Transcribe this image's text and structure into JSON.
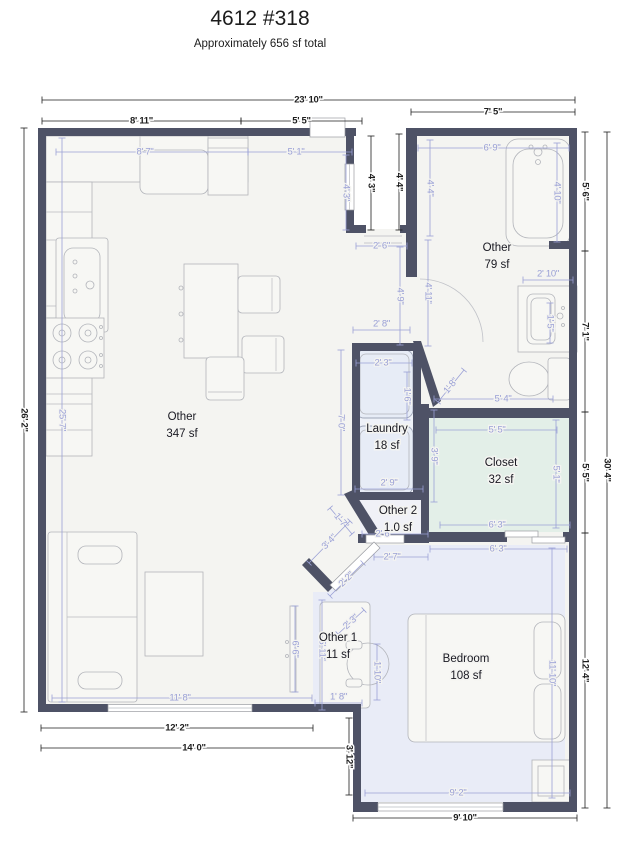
{
  "title": "4612 #318",
  "subtitle": "Approximately 656 sf total",
  "colors": {
    "wall": "#4e5266",
    "floor": "#f4f4f1",
    "bedroom_tint": "#e9ecf7",
    "closet_tint": "#e3efe8",
    "appliance_tint": "#e7ecf6",
    "dim_ext": "#1e1e1e",
    "dim_int": "#9aa0d6",
    "label": "#191922"
  },
  "rooms": [
    {
      "id": "other-main",
      "name": "Other",
      "area": "347 sf",
      "x": 182,
      "y": 420
    },
    {
      "id": "other-bath",
      "name": "Other",
      "area": "79 sf",
      "x": 497,
      "y": 251
    },
    {
      "id": "laundry",
      "name": "Laundry",
      "area": "18 sf",
      "x": 387,
      "y": 432
    },
    {
      "id": "closet",
      "name": "Closet",
      "area": "32 sf",
      "x": 501,
      "y": 466
    },
    {
      "id": "other-2",
      "name": "Other 2",
      "area": "1.0 sf",
      "x": 398,
      "y": 514
    },
    {
      "id": "other-1",
      "name": "Other 1",
      "area": "11 sf",
      "x": 338,
      "y": 641
    },
    {
      "id": "bedroom",
      "name": "Bedroom",
      "area": "108 sf",
      "x": 466,
      "y": 662
    }
  ],
  "ext_dims": [
    {
      "t": "23' 10\"",
      "x1": 42,
      "y1": 100,
      "x2": 575,
      "y2": 100
    },
    {
      "t": "8' 11\"",
      "x1": 42,
      "y1": 121,
      "x2": 241,
      "y2": 121
    },
    {
      "t": "5' 5\"",
      "x1": 241,
      "y1": 121,
      "x2": 362,
      "y2": 121
    },
    {
      "t": "7' 5\"",
      "x1": 411,
      "y1": 112,
      "x2": 575,
      "y2": 112
    },
    {
      "t": "4' 3\"",
      "x1": 371,
      "y1": 136,
      "x2": 371,
      "y2": 230
    },
    {
      "t": "4' 4\"",
      "x1": 399,
      "y1": 134,
      "x2": 399,
      "y2": 230
    },
    {
      "t": "5' 6\"",
      "x1": 585,
      "y1": 132,
      "x2": 585,
      "y2": 251
    },
    {
      "t": "7' 1\"",
      "x1": 585,
      "y1": 251,
      "x2": 585,
      "y2": 412
    },
    {
      "t": "5' 5\"",
      "x1": 585,
      "y1": 412,
      "x2": 585,
      "y2": 533
    },
    {
      "t": "12' 4\"",
      "x1": 585,
      "y1": 533,
      "x2": 585,
      "y2": 808
    },
    {
      "t": "30' 4\"",
      "x1": 607,
      "y1": 132,
      "x2": 607,
      "y2": 808
    },
    {
      "t": "26' 2\"",
      "x1": 24,
      "y1": 128,
      "x2": 24,
      "y2": 712
    },
    {
      "t": "12' 2\"",
      "x1": 41,
      "y1": 728,
      "x2": 313,
      "y2": 728
    },
    {
      "t": "14' 0\"",
      "x1": 41,
      "y1": 748,
      "x2": 347,
      "y2": 748
    },
    {
      "t": "3' 12\"",
      "x1": 349,
      "y1": 718,
      "x2": 349,
      "y2": 795
    },
    {
      "t": "9' 10\"",
      "x1": 353,
      "y1": 818,
      "x2": 577,
      "y2": 818
    }
  ],
  "int_dims": [
    {
      "t": "8' 7\"",
      "x1": 56,
      "y1": 152,
      "x2": 248,
      "y2": 152,
      "tx": 145
    },
    {
      "t": "5' 1\"",
      "x1": 248,
      "y1": 152,
      "x2": 352,
      "y2": 152,
      "tx": 296
    },
    {
      "t": "4' 3\"",
      "x1": 346,
      "y1": 155,
      "x2": 346,
      "y2": 230
    },
    {
      "t": "4' 4\"",
      "x1": 430,
      "y1": 140,
      "x2": 430,
      "y2": 236
    },
    {
      "t": "6' 9\"",
      "x1": 418,
      "y1": 148,
      "x2": 569,
      "y2": 148,
      "tx": 492
    },
    {
      "t": "4' 10\"",
      "x1": 557,
      "y1": 143,
      "x2": 557,
      "y2": 242
    },
    {
      "t": "2' 6\"",
      "x1": 356,
      "y1": 246,
      "x2": 407,
      "y2": 246
    },
    {
      "t": "4' 9\"",
      "x1": 400,
      "y1": 247,
      "x2": 400,
      "y2": 345
    },
    {
      "t": "4' 11\"",
      "x1": 428,
      "y1": 240,
      "x2": 428,
      "y2": 346
    },
    {
      "t": "2' 8\"",
      "x1": 353,
      "y1": 330,
      "x2": 410,
      "y2": 330,
      "ty": 324
    },
    {
      "t": "2' 10\"",
      "x1": 523,
      "y1": 280,
      "x2": 573,
      "y2": 280,
      "ty": 274
    },
    {
      "t": "1' 5\"",
      "x1": 550,
      "y1": 303,
      "x2": 550,
      "y2": 343
    },
    {
      "t": "5' 4\"",
      "x1": 434,
      "y1": 399,
      "x2": 553,
      "y2": 399,
      "tx": 503
    },
    {
      "t": "1' 8\"",
      "x1": 438,
      "y1": 402,
      "x2": 464,
      "y2": 370
    },
    {
      "t": "7' 0\"",
      "x1": 341,
      "y1": 350,
      "x2": 341,
      "y2": 495
    },
    {
      "t": "2' 3\"",
      "x1": 356,
      "y1": 363,
      "x2": 412,
      "y2": 363,
      "tx": 383
    },
    {
      "t": "1' 6\"",
      "x1": 407,
      "y1": 372,
      "x2": 407,
      "y2": 420
    },
    {
      "t": "2' 9\"",
      "x1": 355,
      "y1": 489,
      "x2": 423,
      "y2": 489,
      "ty": 483
    },
    {
      "t": "3' 9\"",
      "x1": 434,
      "y1": 410,
      "x2": 434,
      "y2": 502
    },
    {
      "t": "5' 5\"",
      "x1": 436,
      "y1": 430,
      "x2": 557,
      "y2": 430,
      "tx": 497
    },
    {
      "t": "5' 1\"",
      "x1": 556,
      "y1": 420,
      "x2": 556,
      "y2": 528
    },
    {
      "t": "6' 3\"",
      "x1": 440,
      "y1": 525,
      "x2": 570,
      "y2": 525,
      "tx": 497
    },
    {
      "t": "6' 3\"",
      "x1": 430,
      "y1": 549,
      "x2": 567,
      "y2": 549,
      "tx": 498
    },
    {
      "t": "2' 7\"",
      "x1": 374,
      "y1": 557,
      "x2": 428,
      "y2": 557,
      "tx": 392
    },
    {
      "t": "1' 7\"",
      "x1": 330,
      "y1": 508,
      "x2": 352,
      "y2": 534
    },
    {
      "t": "3' 4\"",
      "x1": 309,
      "y1": 563,
      "x2": 350,
      "y2": 521
    },
    {
      "t": "2' 2\"",
      "x1": 330,
      "y1": 596,
      "x2": 363,
      "y2": 563
    },
    {
      "t": "2' 6\"",
      "x1": 362,
      "y1": 534,
      "x2": 428,
      "y2": 534,
      "tx": 384
    },
    {
      "t": "25' 7\"",
      "x1": 62,
      "y1": 138,
      "x2": 62,
      "y2": 702
    },
    {
      "t": "11' 8\"",
      "x1": 52,
      "y1": 698,
      "x2": 312,
      "y2": 698,
      "tx": 180
    },
    {
      "t": "5' 11\"",
      "x1": 322,
      "y1": 600,
      "x2": 322,
      "y2": 710,
      "ty": 650
    },
    {
      "t": "2' 3\"",
      "x1": 338,
      "y1": 634,
      "x2": 364,
      "y2": 610
    },
    {
      "t": "1' 8\"",
      "x1": 315,
      "y1": 703,
      "x2": 362,
      "y2": 703,
      "ty": 697
    },
    {
      "t": "1' 10\"",
      "x1": 377,
      "y1": 644,
      "x2": 377,
      "y2": 700
    },
    {
      "t": "6' 6\"",
      "x1": 295,
      "y1": 606,
      "x2": 295,
      "y2": 692
    },
    {
      "t": "11' 10\"",
      "x1": 552,
      "y1": 548,
      "x2": 552,
      "y2": 798
    },
    {
      "t": "9' 2\"",
      "x1": 365,
      "y1": 793,
      "x2": 570,
      "y2": 793,
      "tx": 458
    }
  ]
}
